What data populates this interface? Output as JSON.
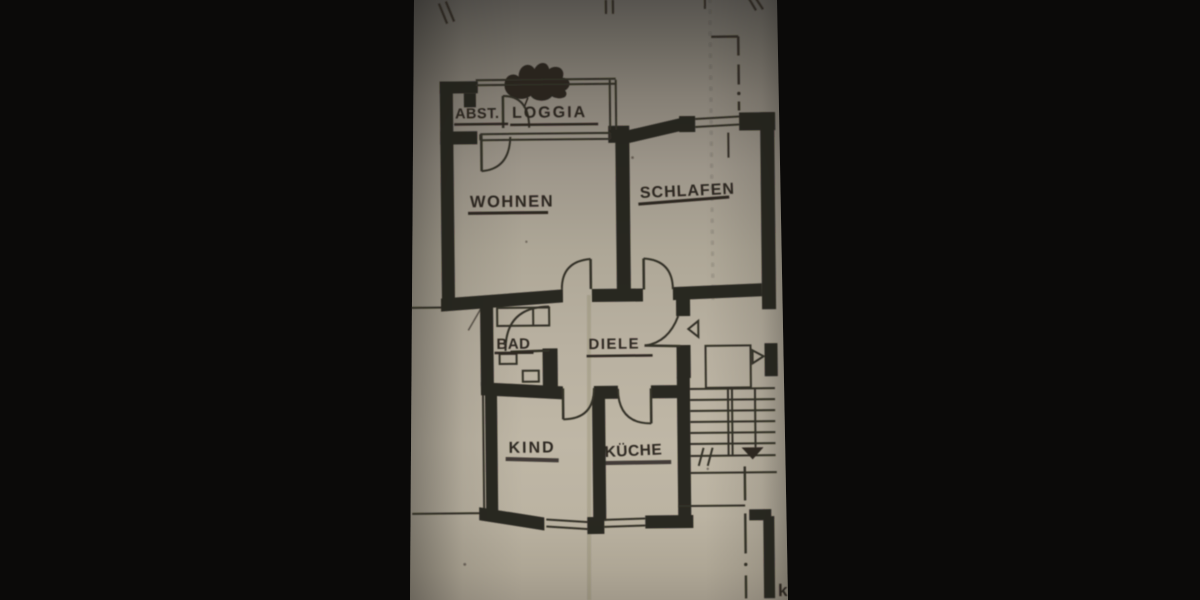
{
  "floor_plan": {
    "type": "apartment-floor-plan-photo",
    "rooms": [
      {
        "id": "abst",
        "label": "ABST."
      },
      {
        "id": "loggia",
        "label": "LOGGIA"
      },
      {
        "id": "wohnen",
        "label": "WOHNEN"
      },
      {
        "id": "schlafen",
        "label": "SCHLAFEN"
      },
      {
        "id": "bad",
        "label": "BAD"
      },
      {
        "id": "diele",
        "label": "DIELE"
      },
      {
        "id": "kind",
        "label": "KIND"
      },
      {
        "id": "kueche",
        "label": "KÜCHE"
      }
    ],
    "partial_text_bottom_right": "k",
    "colors": {
      "photo_background": "#0b0a09",
      "paper": "#b3ab9b",
      "ink": "#221e18"
    }
  }
}
